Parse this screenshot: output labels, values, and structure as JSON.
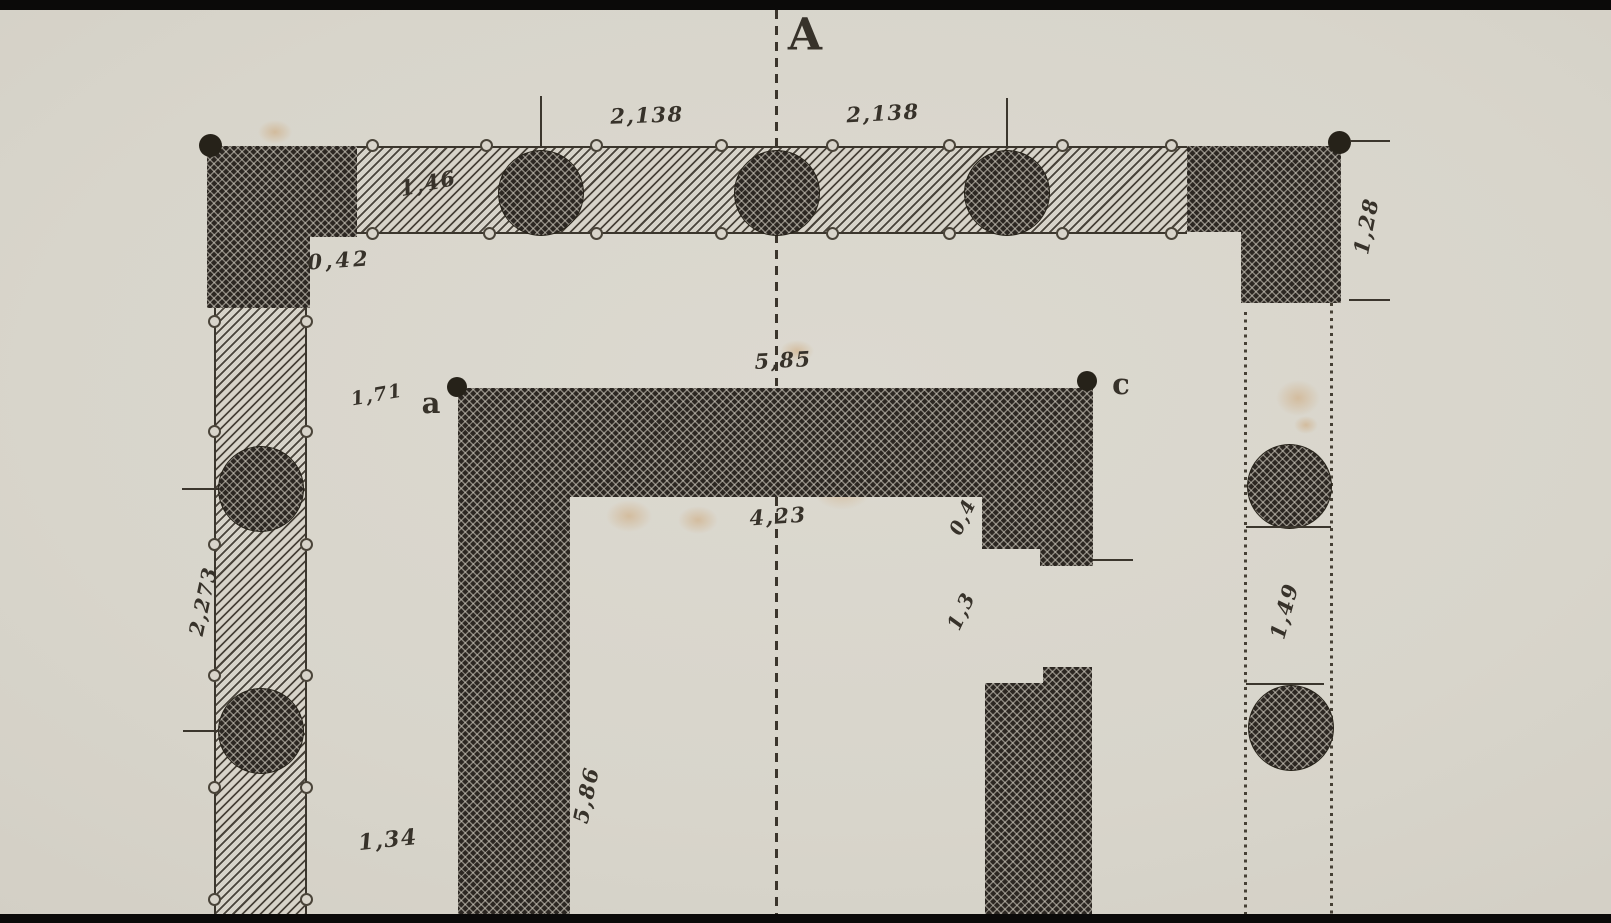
{
  "plan": {
    "section_letter": "A",
    "points": {
      "a": "a",
      "c": "c"
    },
    "dimensions": {
      "top_bay_left": "2,138",
      "top_bay_right": "2,138",
      "top_wall_thickness": "1,46",
      "pier_offset": "0,42",
      "cella_front_width": "5,85",
      "antae_offset": "1,71",
      "cella_inner_width": "4,23",
      "door_jamb": "0,4",
      "door_opening": "1,3",
      "left_bay": "2,273",
      "right_bay": "1,49",
      "cella_side_length": "5,86",
      "left_clearance": "1,34",
      "pier_side": "1,28"
    },
    "colors": {
      "paper": "#d8d4ca",
      "ink": "#3b362d",
      "masonry_dark": "#2c2722",
      "foxing": "#c5863e"
    }
  }
}
